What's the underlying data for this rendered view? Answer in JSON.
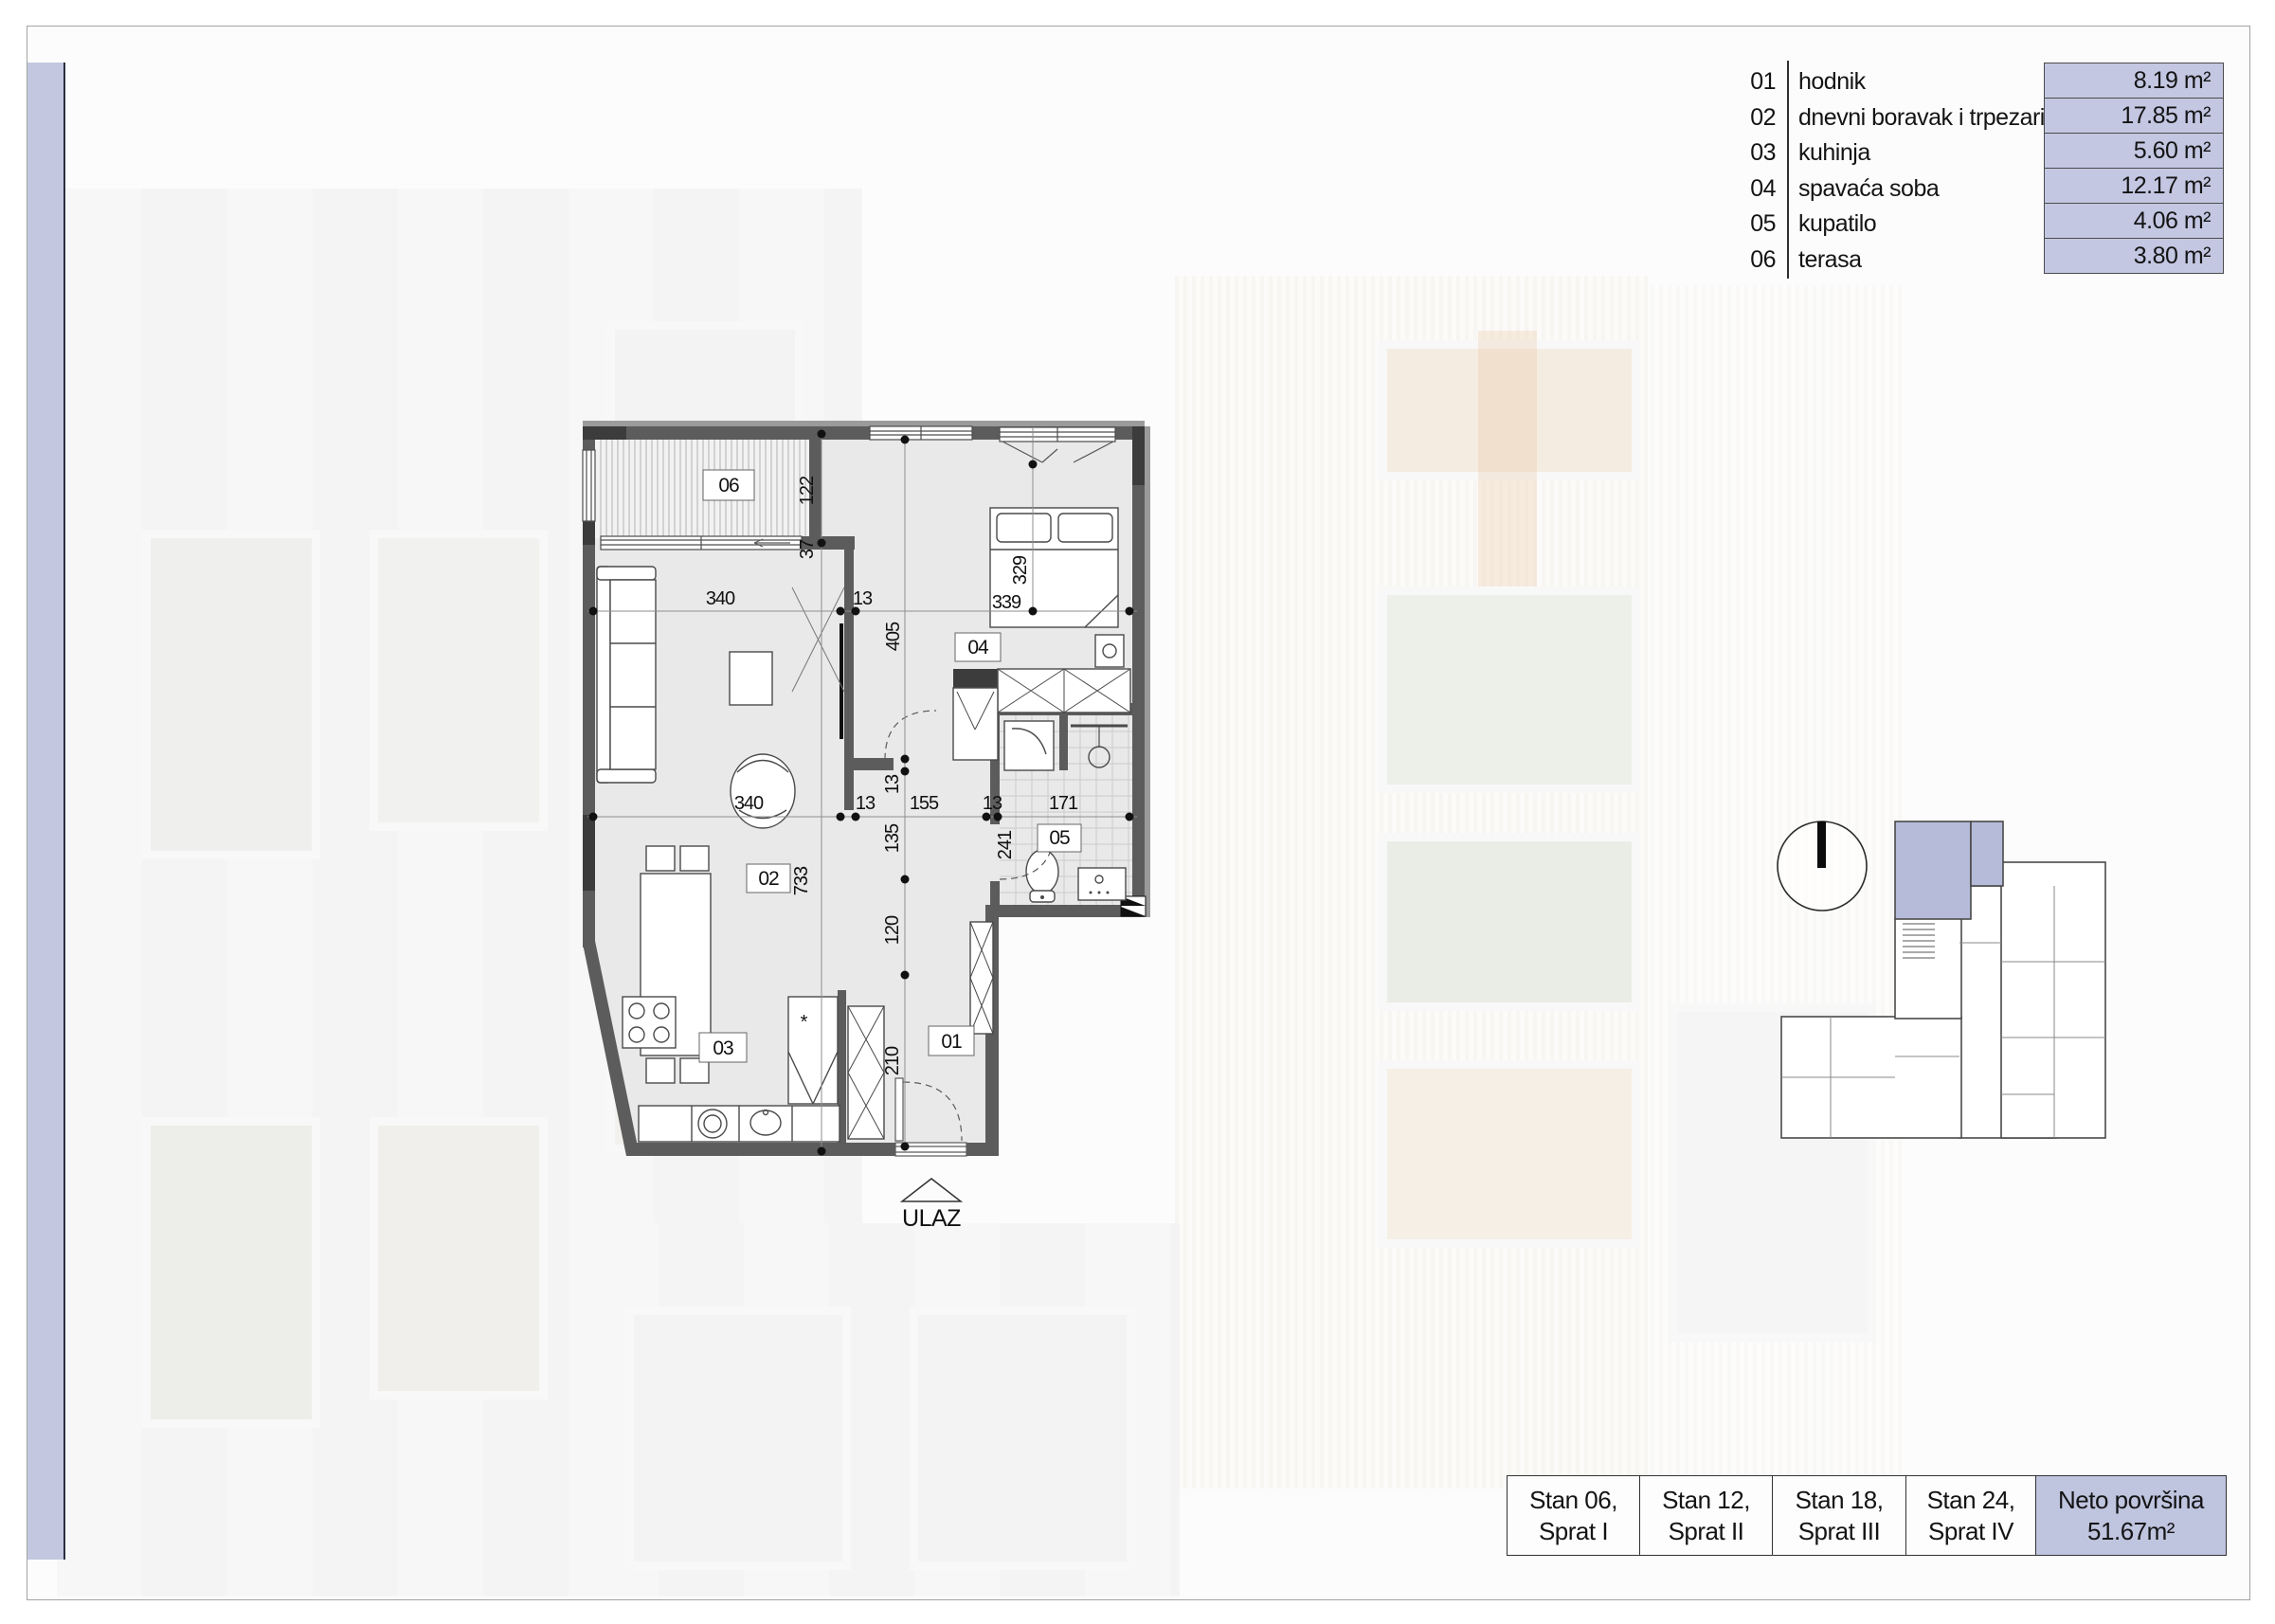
{
  "legend": {
    "rows": [
      {
        "num": "01",
        "label": "hodnik",
        "area": "8.19 m²"
      },
      {
        "num": "02",
        "label": "dnevni boravak i trpezarija",
        "area": "17.85 m²"
      },
      {
        "num": "03",
        "label": "kuhinja",
        "area": "5.60 m²"
      },
      {
        "num": "04",
        "label": "spavaća soba",
        "area": "12.17 m²"
      },
      {
        "num": "05",
        "label": "kupatilo",
        "area": "4.06 m²"
      },
      {
        "num": "06",
        "label": "terasa",
        "area": "3.80 m²"
      }
    ]
  },
  "plan": {
    "entrance_label": "ULAZ",
    "kitchen_star": "*",
    "tags": {
      "t01": "01",
      "t02": "02",
      "t03": "03",
      "t04": "04",
      "t05": "05",
      "t06": "06"
    },
    "dims": [
      "340",
      "13",
      "339",
      "329",
      "122",
      "37",
      "405",
      "13",
      "340",
      "13",
      "155",
      "13",
      "171",
      "241",
      "135",
      "120",
      "210",
      "733"
    ]
  },
  "footer": {
    "units": [
      {
        "l1": "Stan 06,",
        "l2": "Sprat I"
      },
      {
        "l1": "Stan 12,",
        "l2": "Sprat II"
      },
      {
        "l1": "Stan 18,",
        "l2": "Sprat III"
      },
      {
        "l1": "Stan 24,",
        "l2": "Sprat IV"
      }
    ],
    "total": {
      "l1": "Neto površina",
      "l2": "51.67m²"
    }
  },
  "colors": {
    "accent": "#c3c8e0",
    "area_box": "#c3c7e2",
    "highlight_unit": "#b5bbd8",
    "wall": "#5c5c5c"
  }
}
